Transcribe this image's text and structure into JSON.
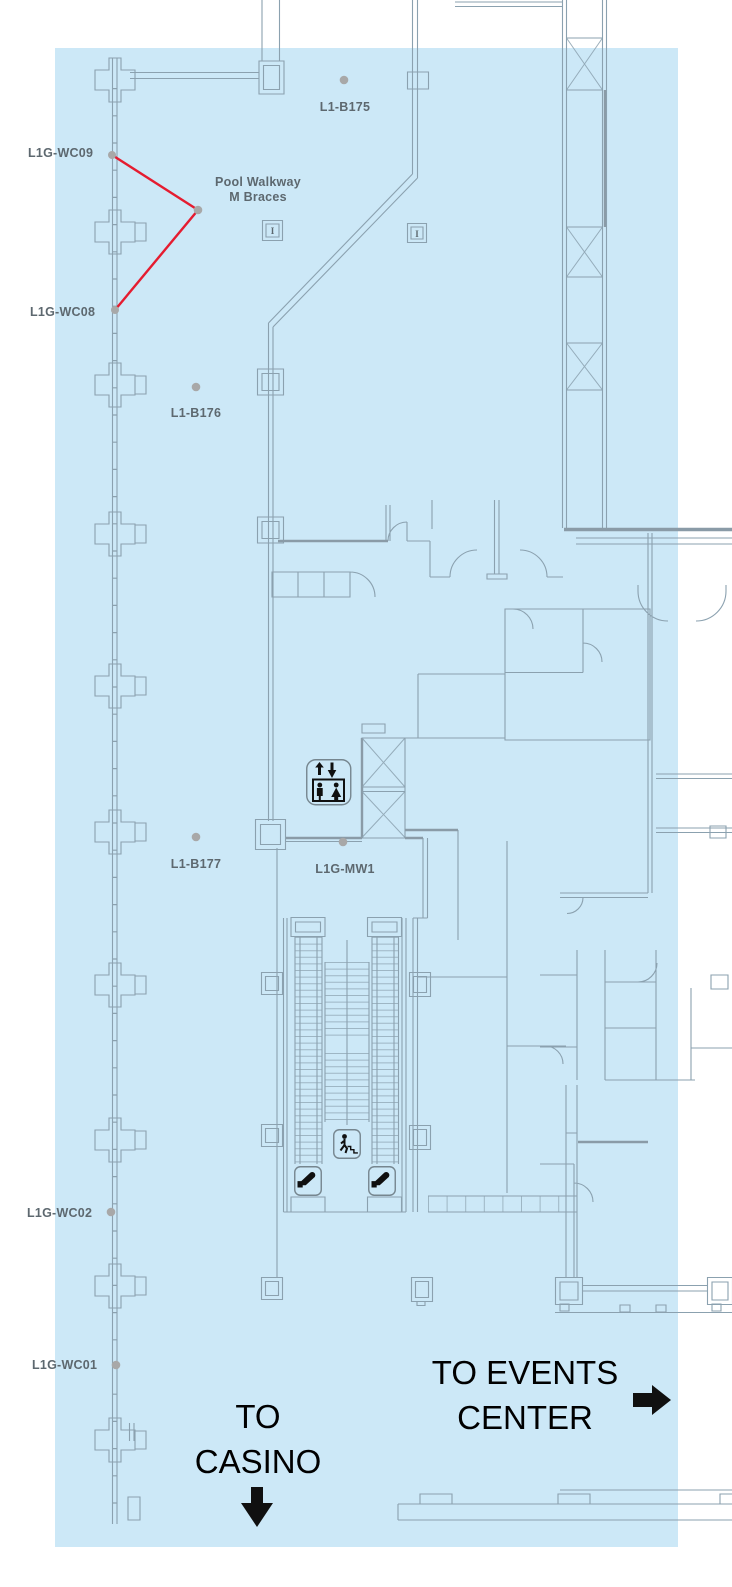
{
  "colors": {
    "highlight": "#cce8f7",
    "wall": "#8ba1af",
    "wall_strong": "#8a9ba7",
    "label": "#5d686f",
    "marker": "#a8a8a8",
    "callout": "#e51c30",
    "icon_border": "#76868f",
    "icon_glyph": "#101010",
    "direction_text": "#000000"
  },
  "labels": {
    "b175": "L1-B175",
    "wc09": "L1G-WC09",
    "pool_walkway_1": "Pool Walkway",
    "pool_walkway_2": "M Braces",
    "wc08": "L1G-WC08",
    "b176": "L1-B176",
    "b177": "L1-B177",
    "mw1": "L1G-MW1",
    "wc02": "L1G-WC02",
    "wc01": "L1G-WC01"
  },
  "directions": {
    "casino_1": "TO",
    "casino_2": "CASINO",
    "events_1": "TO EVENTS",
    "events_2": "CENTER"
  },
  "symbols": {
    "column_marker": "I"
  },
  "icons": {
    "elevator": "elevator-icon",
    "escalator": "escalator-icon",
    "stairs": "stairs-icon",
    "casino_arrow": "down-arrow-icon",
    "events_arrow": "right-arrow-icon"
  }
}
